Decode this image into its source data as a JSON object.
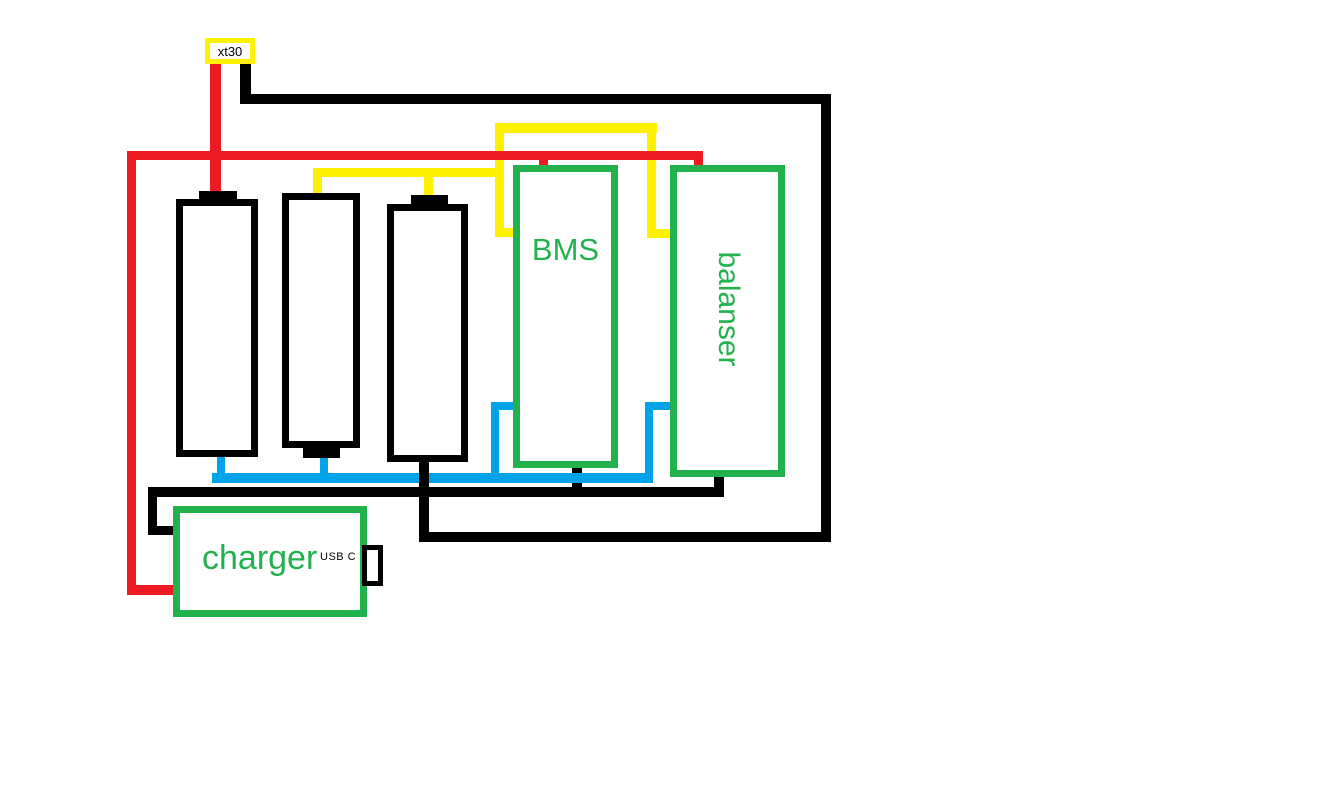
{
  "colors": {
    "background": "#FFFFFF",
    "wire_red": "#ED1C24",
    "wire_yellow": "#FFF200",
    "wire_blue": "#00A2E8",
    "wire_black": "#000000",
    "component_green": "#22B14C",
    "label_black": "#000000"
  },
  "components": {
    "xt30": {
      "label": "xt30"
    },
    "bms": {
      "label": "BMS"
    },
    "balancer": {
      "label": "balanser"
    },
    "charger": {
      "label": "charger"
    },
    "usb_port": {
      "label": "USB C"
    }
  },
  "batteries": {
    "count": 3
  }
}
